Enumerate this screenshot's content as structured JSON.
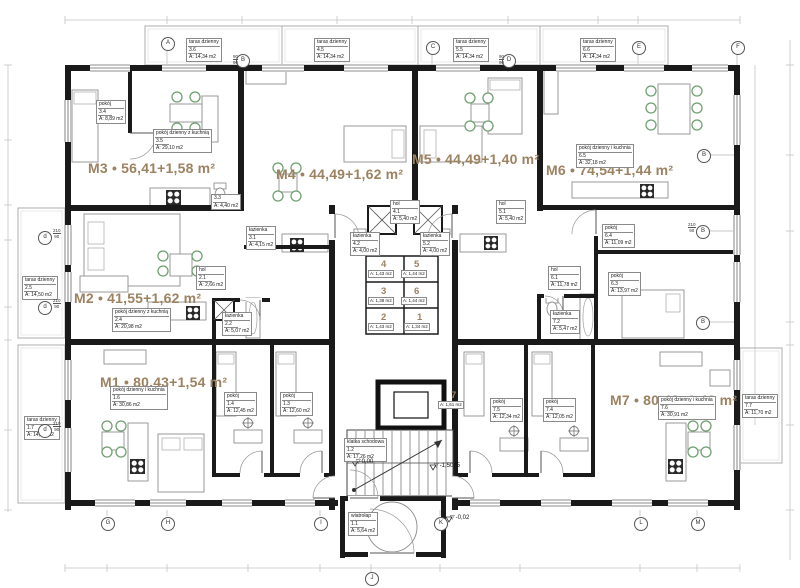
{
  "colors": {
    "accent": "#9c8261",
    "wall": "#1a1a1a"
  },
  "apartments": [
    {
      "id": "M3",
      "label": "M3 • 56,41+1,58 m²",
      "x": 88,
      "y": 160
    },
    {
      "id": "M4",
      "label": "M4 • 44,49+1,62 m²",
      "x": 276,
      "y": 166
    },
    {
      "id": "M5",
      "label": "M5 • 44,49+1,40 m²",
      "x": 412,
      "y": 151
    },
    {
      "id": "M6",
      "label": "M6 • 74,54+1,44 m²",
      "x": 546,
      "y": 162
    },
    {
      "id": "M2",
      "label": "M2 • 41,55+1,62 m²",
      "x": 74,
      "y": 290
    },
    {
      "id": "M1",
      "label": "M1 • 80,43+1,54 m²",
      "x": 100,
      "y": 374
    },
    {
      "id": "M7",
      "label": "M7 • 80,48+1,43 m²",
      "x": 610,
      "y": 392
    }
  ],
  "rooms": [
    {
      "name": "pokój",
      "num": "3.4",
      "area": "A: 8,89 m2",
      "x": 96,
      "y": 100
    },
    {
      "name": "pokój dzienny z kuchnią",
      "num": "3.5",
      "area": "A: 29,10 m2",
      "x": 153,
      "y": 129
    },
    {
      "name": "",
      "num": "3.3",
      "area": "A: 4,40 m2",
      "x": 211,
      "y": 194
    },
    {
      "name": "łazienka",
      "num": "3.1",
      "area": "A: 4,15 m2",
      "x": 246,
      "y": 226
    },
    {
      "name": "pokój dzienny z kuchnią",
      "num": "2.4",
      "area": "A: 20,98 m2",
      "x": 112,
      "y": 308
    },
    {
      "name": "hol",
      "num": "2.1",
      "area": "A: 2,66 m2",
      "x": 196,
      "y": 266
    },
    {
      "name": "łazienka",
      "num": "2.2",
      "area": "A: 5,07 m2",
      "x": 222,
      "y": 312
    },
    {
      "name": "pokój dzienny i kuchnia",
      "num": "1.6",
      "area": "A: 30,86 m2",
      "x": 110,
      "y": 386
    },
    {
      "name": "pokój",
      "num": "1.4",
      "area": "A: 12,45 m2",
      "x": 224,
      "y": 392
    },
    {
      "name": "pokój",
      "num": "1.3",
      "area": "A: 12,60 m2",
      "x": 280,
      "y": 392
    },
    {
      "name": "hol",
      "num": "4.1",
      "area": "A: 5,40 m2",
      "x": 390,
      "y": 200
    },
    {
      "name": "hol",
      "num": "5.1",
      "area": "A: 5,40 m2",
      "x": 496,
      "y": 200
    },
    {
      "name": "łazienka",
      "num": "4.2",
      "area": "A: 4,00 m2",
      "x": 350,
      "y": 232
    },
    {
      "name": "łazienka",
      "num": "5.2",
      "area": "A: 4,00 m2",
      "x": 420,
      "y": 232
    },
    {
      "name": "pokój dzienny i kuchnia",
      "num": "6.5",
      "area": "A: 32,18 m2",
      "x": 576,
      "y": 144
    },
    {
      "name": "hol",
      "num": "6.1",
      "area": "A: 11,78 m2",
      "x": 548,
      "y": 266
    },
    {
      "name": "pokój",
      "num": "6.4",
      "area": "A: 11,09 m2",
      "x": 602,
      "y": 224
    },
    {
      "name": "pokój",
      "num": "6.3",
      "area": "A: 13,97 m2",
      "x": 608,
      "y": 272
    },
    {
      "name": "łazienka",
      "num": "7.2",
      "area": "A: 5,47 m2",
      "x": 550,
      "y": 310
    },
    {
      "name": "pokój",
      "num": "7.5",
      "area": "A: 12,34 m2",
      "x": 490,
      "y": 398
    },
    {
      "name": "pokój",
      "num": "7.4",
      "area": "A: 12,05 m2",
      "x": 543,
      "y": 398
    },
    {
      "name": "pokój dzienny i kuchnia",
      "num": "7.6",
      "area": "A: 30,91 m2",
      "x": 658,
      "y": 396
    },
    {
      "name": "klatka schodowa",
      "num": "1.2",
      "area": "A: 17,26 m2",
      "x": 344,
      "y": 438
    },
    {
      "name": "wiatrołap",
      "num": "1.1",
      "area": "A: 5,64 m2",
      "x": 348,
      "y": 512
    },
    {
      "name": "taras dzienny",
      "num": "3.6",
      "area": "A: 14,34 m2",
      "x": 186,
      "y": 38
    },
    {
      "name": "taras dzienny",
      "num": "4.5",
      "area": "A: 14,34 m2",
      "x": 314,
      "y": 38
    },
    {
      "name": "taras dzienny",
      "num": "5.5",
      "area": "A: 14,34 m2",
      "x": 453,
      "y": 38
    },
    {
      "name": "taras dzienny",
      "num": "6.6",
      "area": "A: 14,34 m2",
      "x": 580,
      "y": 38
    },
    {
      "name": "taras dzienny",
      "num": "2.5",
      "area": "A: 14,50 m2",
      "x": 22,
      "y": 276
    },
    {
      "name": "taras dzienny",
      "num": "1.7",
      "area": "A: 14,50 m2",
      "x": 24,
      "y": 416
    },
    {
      "name": "taras dzienny",
      "num": "7.7",
      "area": "A: 11,70 m2",
      "x": 742,
      "y": 394
    }
  ],
  "lockers": [
    {
      "num": "4",
      "area": "A: 1,43 m2",
      "x": 381,
      "y": 259
    },
    {
      "num": "5",
      "area": "A: 1,44 m2",
      "x": 414,
      "y": 259
    },
    {
      "num": "3",
      "area": "A: 1,38 m2",
      "x": 381,
      "y": 286
    },
    {
      "num": "6",
      "area": "A: 1,44 m2",
      "x": 414,
      "y": 286
    },
    {
      "num": "2",
      "area": "A: 1,43 m2",
      "x": 381,
      "y": 312
    },
    {
      "num": "1",
      "area": "A: 1,34 m2",
      "x": 417,
      "y": 312
    },
    {
      "num": "7",
      "area": "A: 1,61 m2",
      "x": 451,
      "y": 390
    }
  ],
  "elevations": [
    {
      "label": "0,00",
      "x": 356,
      "y": 458
    },
    {
      "label": "-1,5075",
      "x": 434,
      "y": 462
    },
    {
      "label": "-0,02",
      "x": 450,
      "y": 514
    }
  ],
  "axis_markers": {
    "top": [
      {
        "label": "A",
        "x": 167,
        "y": 43
      },
      {
        "label": "B",
        "x": 242,
        "y": 60
      },
      {
        "label": "C",
        "x": 432,
        "y": 47
      },
      {
        "label": "D",
        "x": 508,
        "y": 60
      },
      {
        "label": "E",
        "x": 638,
        "y": 47
      },
      {
        "label": "F",
        "x": 737,
        "y": 47
      }
    ],
    "bottom": [
      {
        "label": "G",
        "x": 107,
        "y": 523
      },
      {
        "label": "H",
        "x": 167,
        "y": 523
      },
      {
        "label": "I",
        "x": 320,
        "y": 523
      },
      {
        "label": "J",
        "x": 371,
        "y": 578
      },
      {
        "label": "K",
        "x": 440,
        "y": 523
      },
      {
        "label": "L",
        "x": 640,
        "y": 523
      },
      {
        "label": "M",
        "x": 697,
        "y": 523
      }
    ],
    "left": [
      {
        "label": "d",
        "x": 44,
        "y": 237
      },
      {
        "label": "d",
        "x": 44,
        "y": 307
      },
      {
        "label": "d",
        "x": 44,
        "y": 430
      }
    ],
    "right": [
      {
        "label": "B",
        "x": 703,
        "y": 155
      },
      {
        "label": "B",
        "x": 702,
        "y": 231
      },
      {
        "label": "B",
        "x": 702,
        "y": 322
      }
    ]
  },
  "window_marks": [
    {
      "top": "90",
      "bottom": "90",
      "x": 233,
      "y": 54
    },
    {
      "top": "90",
      "bottom": "90",
      "x": 499,
      "y": 54
    },
    {
      "top": "210",
      "bottom": "90",
      "x": 53,
      "y": 228
    },
    {
      "top": "210",
      "bottom": "90",
      "x": 53,
      "y": 298
    },
    {
      "top": "210",
      "bottom": "90",
      "x": 53,
      "y": 421
    },
    {
      "top": "210",
      "bottom": "90",
      "x": 688,
      "y": 222
    }
  ]
}
